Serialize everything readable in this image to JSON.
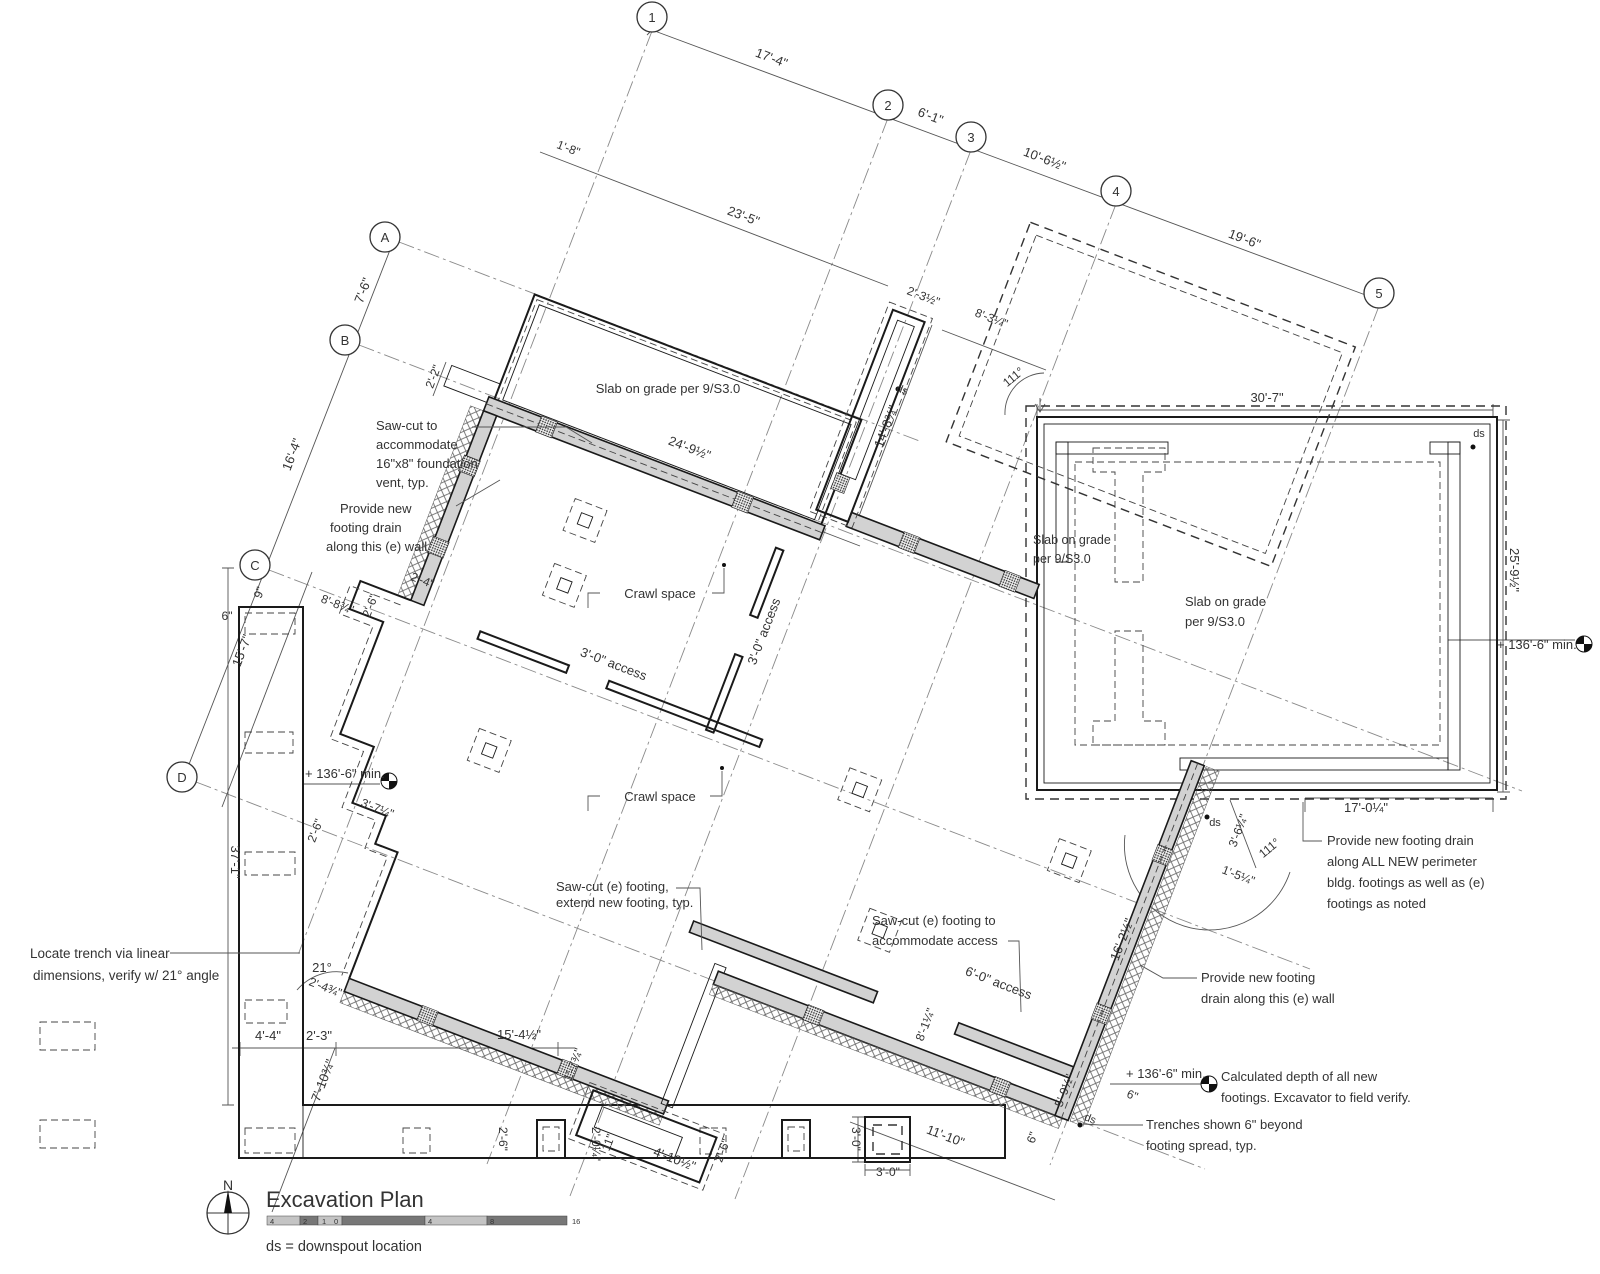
{
  "title_block": {
    "title": "Excavation Plan",
    "legend": "ds = downspout location",
    "north_label": "N",
    "scale_ticks": [
      "4",
      "2",
      "1",
      "0",
      "4",
      "8",
      "16"
    ]
  },
  "grid": {
    "columns": [
      {
        "label": "1",
        "x": 652,
        "y": 17
      },
      {
        "label": "2",
        "x": 888,
        "y": 105
      },
      {
        "label": "3",
        "x": 971,
        "y": 137
      },
      {
        "label": "4",
        "x": 1116,
        "y": 191
      },
      {
        "label": "5",
        "x": 1379,
        "y": 293
      }
    ],
    "rows": [
      {
        "label": "A",
        "x": 385,
        "y": 237
      },
      {
        "label": "B",
        "x": 345,
        "y": 340
      },
      {
        "label": "C",
        "x": 255,
        "y": 565
      },
      {
        "label": "D",
        "x": 182,
        "y": 777
      }
    ]
  },
  "annotations": [
    {
      "name": "dim-17-4",
      "text": "17'-4\"",
      "x": 770,
      "y": 62,
      "rot": 21,
      "size": 13
    },
    {
      "name": "dim-6-1",
      "text": "6'-1\"",
      "x": 929,
      "y": 120,
      "rot": 21,
      "size": 13
    },
    {
      "name": "dim-10-6-half",
      "text": "10'-6½\"",
      "x": 1043,
      "y": 163,
      "rot": 21,
      "size": 13
    },
    {
      "name": "dim-19-6",
      "text": "19'-6\"",
      "x": 1243,
      "y": 243,
      "rot": 21,
      "size": 13
    },
    {
      "name": "dim-1-8",
      "text": "1'-8\"",
      "x": 567,
      "y": 152,
      "rot": 21,
      "size": 12
    },
    {
      "name": "dim-23-5",
      "text": "23'-5\"",
      "x": 742,
      "y": 220,
      "rot": 21,
      "size": 13
    },
    {
      "name": "dim-7-6",
      "text": "7'-6\"",
      "x": 367,
      "y": 292,
      "rot": -69,
      "size": 13
    },
    {
      "name": "dim-16-4",
      "text": "16'-4\"",
      "x": 296,
      "y": 456,
      "rot": -69,
      "size": 13
    },
    {
      "name": "dim-2-2",
      "text": "2'-2\"",
      "x": 437,
      "y": 378,
      "rot": -69,
      "size": 12
    },
    {
      "name": "dim-24-9-half",
      "text": "24'-9½\"",
      "x": 688,
      "y": 452,
      "rot": 21,
      "size": 13
    },
    {
      "name": "dim-2-3-half",
      "text": "2'-3½\"",
      "x": 922,
      "y": 300,
      "rot": 21,
      "size": 12
    },
    {
      "name": "dim-8-3-quarter",
      "text": "8'-3¼\"",
      "x": 990,
      "y": 322,
      "rot": 21,
      "size": 12
    },
    {
      "name": "angle-111-top",
      "text": "111°",
      "x": 1016,
      "y": 380,
      "rot": -40,
      "size": 12
    },
    {
      "name": "dim-14-8",
      "text": "14'-8¾\"",
      "x": 890,
      "y": 428,
      "rot": -69,
      "size": 13
    },
    {
      "name": "ds-top",
      "text": "ds",
      "x": 901,
      "y": 393,
      "rot": 21,
      "size": 11
    },
    {
      "name": "dim-30-7",
      "text": "30'-7\"",
      "x": 1267,
      "y": 402,
      "rot": 0,
      "size": 13
    },
    {
      "name": "ds-top-right",
      "text": "ds",
      "x": 1479,
      "y": 437,
      "rot": 0,
      "size": 11
    },
    {
      "name": "dim-25-9-half",
      "text": "25'-9½\"",
      "x": 1510,
      "y": 570,
      "rot": 90,
      "size": 13
    },
    {
      "name": "elev-136-6-right",
      "text": "+ 136'-6\" min.",
      "x": 1497,
      "y": 649,
      "rot": 0,
      "size": 13,
      "anchor": "start"
    },
    {
      "name": "label-slab-1",
      "text": "Slab on grade per 9/S3.0",
      "x": 668,
      "y": 393,
      "rot": 0,
      "size": 13
    },
    {
      "name": "label-slab-2a",
      "text": "Slab on grade",
      "x": 1033,
      "y": 544,
      "rot": 0,
      "size": 12.5,
      "anchor": "start"
    },
    {
      "name": "label-slab-2b",
      "text": "per 9/S3.0",
      "x": 1033,
      "y": 563,
      "rot": 0,
      "size": 12.5,
      "anchor": "start"
    },
    {
      "name": "label-slab-3a",
      "text": "Slab on grade",
      "x": 1185,
      "y": 606,
      "rot": 0,
      "size": 13,
      "anchor": "start"
    },
    {
      "name": "label-slab-3b",
      "text": "per 9/S3.0",
      "x": 1185,
      "y": 626,
      "rot": 0,
      "size": 13,
      "anchor": "start"
    },
    {
      "name": "label-crawl-1",
      "text": "Crawl space",
      "x": 660,
      "y": 598,
      "rot": 0,
      "size": 13
    },
    {
      "name": "label-crawl-2",
      "text": "Crawl space",
      "x": 660,
      "y": 801,
      "rot": 0,
      "size": 13
    },
    {
      "name": "label-access-3-0-a",
      "text": "3'-0\" access",
      "x": 612,
      "y": 668,
      "rot": 21,
      "size": 13
    },
    {
      "name": "label-access-3-0-b",
      "text": "3'-0\" access",
      "x": 768,
      "y": 633,
      "rot": -69,
      "size": 13
    },
    {
      "name": "dim-8-8",
      "text": "8'-8¾\"",
      "x": 336,
      "y": 608,
      "rot": 21,
      "size": 12
    },
    {
      "name": "dim-2-6-a",
      "text": "2'-6\"",
      "x": 374,
      "y": 607,
      "rot": -69,
      "size": 12
    },
    {
      "name": "dim-2-4",
      "text": "2'-4\"",
      "x": 421,
      "y": 584,
      "rot": 21,
      "size": 12
    },
    {
      "name": "dim-6in-left",
      "text": "6\"",
      "x": 227,
      "y": 620,
      "rot": 0,
      "size": 12
    },
    {
      "name": "dim-9in",
      "text": "9\"",
      "x": 263,
      "y": 594,
      "rot": -69,
      "size": 12
    },
    {
      "name": "dim-15-7",
      "text": "15'-7\"",
      "x": 246,
      "y": 652,
      "rot": -69,
      "size": 13
    },
    {
      "name": "dim-37-1",
      "text": "37'-1\"",
      "x": 231,
      "y": 862,
      "rot": 90,
      "size": 13
    },
    {
      "name": "elev-136-6-left",
      "text": "+ 136'-6\" min.",
      "x": 305,
      "y": 778,
      "rot": 0,
      "size": 13,
      "anchor": "start"
    },
    {
      "name": "dim-3-7",
      "text": "3'-7¼\"",
      "x": 376,
      "y": 812,
      "rot": 21,
      "size": 12
    },
    {
      "name": "dim-2-6-b",
      "text": "2'-6\"",
      "x": 319,
      "y": 832,
      "rot": -69,
      "size": 12
    },
    {
      "name": "angle-21",
      "text": "21°",
      "x": 322,
      "y": 972,
      "rot": 0,
      "size": 13
    },
    {
      "name": "dim-2-4-3q",
      "text": "2'-4¾\"",
      "x": 324,
      "y": 991,
      "rot": 21,
      "size": 12
    },
    {
      "name": "dim-4-4",
      "text": "4'-4\"",
      "x": 268,
      "y": 1040,
      "rot": 0,
      "size": 13
    },
    {
      "name": "dim-2-3",
      "text": "2'-3\"",
      "x": 319,
      "y": 1040,
      "rot": 0,
      "size": 13
    },
    {
      "name": "dim-15-4-half",
      "text": "15'-4½\"",
      "x": 519,
      "y": 1039,
      "rot": 0,
      "size": 13
    },
    {
      "name": "dim-7-10",
      "text": "7'-10¾\"",
      "x": 327,
      "y": 1082,
      "rot": -69,
      "size": 13
    },
    {
      "name": "dim-1-7",
      "text": "1'-7¾\"",
      "x": 577,
      "y": 1066,
      "rot": -69,
      "size": 12
    },
    {
      "name": "dim-2-0",
      "text": "2'-0¼\"",
      "x": 592,
      "y": 1144,
      "rot": 90,
      "size": 12
    },
    {
      "name": "dim-11in",
      "text": "11\"",
      "x": 612,
      "y": 1144,
      "rot": -69,
      "size": 12
    },
    {
      "name": "dim-4-10-half",
      "text": "4'-10½\"",
      "x": 673,
      "y": 1163,
      "rot": 21,
      "size": 13
    },
    {
      "name": "dim-2-6-c",
      "text": "2'-6\"",
      "x": 726,
      "y": 1152,
      "rot": -69,
      "size": 12
    },
    {
      "name": "dim-2-6-d",
      "text": "2'-6\"",
      "x": 499,
      "y": 1139,
      "rot": 90,
      "size": 12
    },
    {
      "name": "dim-3-0-v",
      "text": "3'-0\"",
      "x": 852,
      "y": 1139,
      "rot": 90,
      "size": 12
    },
    {
      "name": "dim-3-0-h",
      "text": "3'-0\"",
      "x": 888,
      "y": 1176,
      "rot": 0,
      "size": 12
    },
    {
      "name": "dim-11-10",
      "text": "11'-10\"",
      "x": 944,
      "y": 1140,
      "rot": 21,
      "size": 13
    },
    {
      "name": "dim-5-9-half",
      "text": "5'-9½\"",
      "x": 1068,
      "y": 1092,
      "rot": -69,
      "size": 12
    },
    {
      "name": "dim-6in-a",
      "text": "6\"",
      "x": 1131,
      "y": 1099,
      "rot": 21,
      "size": 12
    },
    {
      "name": "dim-6in-b",
      "text": "6\"",
      "x": 1036,
      "y": 1139,
      "rot": -69,
      "size": 12
    },
    {
      "name": "ds-bottom",
      "text": "ds",
      "x": 1089,
      "y": 1122,
      "rot": 21,
      "size": 11
    },
    {
      "name": "elev-136-6-bottom",
      "text": "+ 136'-6\" min.",
      "x": 1126,
      "y": 1078,
      "rot": 0,
      "size": 13,
      "anchor": "start"
    },
    {
      "name": "dim-16-2-half",
      "text": "16'-2½\"",
      "x": 1126,
      "y": 941,
      "rot": -69,
      "size": 13
    },
    {
      "name": "dim-17-0-quarter",
      "text": "17'-0¼\"",
      "x": 1366,
      "y": 812,
      "rot": 0,
      "size": 13
    },
    {
      "name": "dim-3-6-quarter",
      "text": "3'-6¼\"",
      "x": 1242,
      "y": 832,
      "rot": -69,
      "size": 12
    },
    {
      "name": "dim-1-5-quarter",
      "text": "1'-5¼\"",
      "x": 1237,
      "y": 879,
      "rot": 21,
      "size": 12
    },
    {
      "name": "angle-111-bottom",
      "text": "111°",
      "x": 1272,
      "y": 851,
      "rot": -40,
      "size": 12
    },
    {
      "name": "ds-bottom-right-bldg",
      "text": "ds",
      "x": 1215,
      "y": 826,
      "rot": 0,
      "size": 11
    },
    {
      "name": "dim-8-1-quarter",
      "text": "8'-1¼\"",
      "x": 929,
      "y": 1026,
      "rot": -69,
      "size": 12
    },
    {
      "name": "label-access-6-0",
      "text": "6'-0\" access",
      "x": 997,
      "y": 987,
      "rot": 21,
      "size": 13
    },
    {
      "name": "note-sawcut-vent-1",
      "text": "Saw-cut to",
      "x": 376,
      "y": 430,
      "rot": 0,
      "size": 13,
      "anchor": "start"
    },
    {
      "name": "note-sawcut-vent-2",
      "text": "accommodate",
      "x": 376,
      "y": 449,
      "rot": 0,
      "size": 13,
      "anchor": "start"
    },
    {
      "name": "note-sawcut-vent-3",
      "text": "16\"x8\" foundation",
      "x": 376,
      "y": 468,
      "rot": 0,
      "size": 13,
      "anchor": "start"
    },
    {
      "name": "note-sawcut-vent-4",
      "text": "vent, typ.",
      "x": 376,
      "y": 487,
      "rot": 0,
      "size": 13,
      "anchor": "start"
    },
    {
      "name": "note-drain-left-1",
      "text": "Provide new",
      "x": 340,
      "y": 513,
      "rot": 0,
      "size": 13,
      "anchor": "start"
    },
    {
      "name": "note-drain-left-2",
      "text": "footing drain",
      "x": 330,
      "y": 532,
      "rot": 0,
      "size": 13,
      "anchor": "start"
    },
    {
      "name": "note-drain-left-3",
      "text": "along this (e) wall",
      "x": 326,
      "y": 551,
      "rot": 0,
      "size": 13,
      "anchor": "start"
    },
    {
      "name": "note-locate-trench-1",
      "text": "Locate trench via linear",
      "x": 30,
      "y": 958,
      "rot": 0,
      "size": 13.5,
      "anchor": "start"
    },
    {
      "name": "note-locate-trench-2",
      "text": "dimensions, verify w/ 21° angle",
      "x": 33,
      "y": 980,
      "rot": 0,
      "size": 13.5,
      "anchor": "start"
    },
    {
      "name": "note-sawcut-extend-1",
      "text": "Saw-cut (e) footing,",
      "x": 556,
      "y": 891,
      "rot": 0,
      "size": 13,
      "anchor": "start"
    },
    {
      "name": "note-sawcut-extend-2",
      "text": "extend new footing, typ.",
      "x": 556,
      "y": 907,
      "rot": 0,
      "size": 13,
      "anchor": "start"
    },
    {
      "name": "note-sawcut-access-1",
      "text": "Saw-cut (e) footing to",
      "x": 872,
      "y": 925,
      "rot": 0,
      "size": 13,
      "anchor": "start"
    },
    {
      "name": "note-sawcut-access-2",
      "text": "accommodate access",
      "x": 872,
      "y": 945,
      "rot": 0,
      "size": 13,
      "anchor": "start"
    },
    {
      "name": "note-drain-allnew-1",
      "text": "Provide new footing drain",
      "x": 1327,
      "y": 845,
      "rot": 0,
      "size": 13,
      "anchor": "start"
    },
    {
      "name": "note-drain-allnew-2",
      "text": "along ALL NEW perimeter",
      "x": 1327,
      "y": 866,
      "rot": 0,
      "size": 13,
      "anchor": "start"
    },
    {
      "name": "note-drain-allnew-3",
      "text": "bldg. footings as well as (e)",
      "x": 1327,
      "y": 887,
      "rot": 0,
      "size": 13,
      "anchor": "start"
    },
    {
      "name": "note-drain-allnew-4",
      "text": "footings as noted",
      "x": 1327,
      "y": 908,
      "rot": 0,
      "size": 13,
      "anchor": "start"
    },
    {
      "name": "note-drain-right-1",
      "text": "Provide new footing",
      "x": 1201,
      "y": 982,
      "rot": 0,
      "size": 13,
      "anchor": "start"
    },
    {
      "name": "note-drain-right-2",
      "text": "drain along this (e) wall",
      "x": 1201,
      "y": 1003,
      "rot": 0,
      "size": 13,
      "anchor": "start"
    },
    {
      "name": "note-calc-depth-1",
      "text": "Calculated depth of all new",
      "x": 1221,
      "y": 1081,
      "rot": 0,
      "size": 13,
      "anchor": "start"
    },
    {
      "name": "note-calc-depth-2",
      "text": "footings. Excavator to field verify.",
      "x": 1221,
      "y": 1102,
      "rot": 0,
      "size": 13,
      "anchor": "start"
    },
    {
      "name": "note-trenches-1",
      "text": "Trenches shown 6\" beyond",
      "x": 1146,
      "y": 1129,
      "rot": 0,
      "size": 13,
      "anchor": "start"
    },
    {
      "name": "note-trenches-2",
      "text": "footing spread, typ.",
      "x": 1146,
      "y": 1150,
      "rot": 0,
      "size": 13,
      "anchor": "start"
    }
  ]
}
